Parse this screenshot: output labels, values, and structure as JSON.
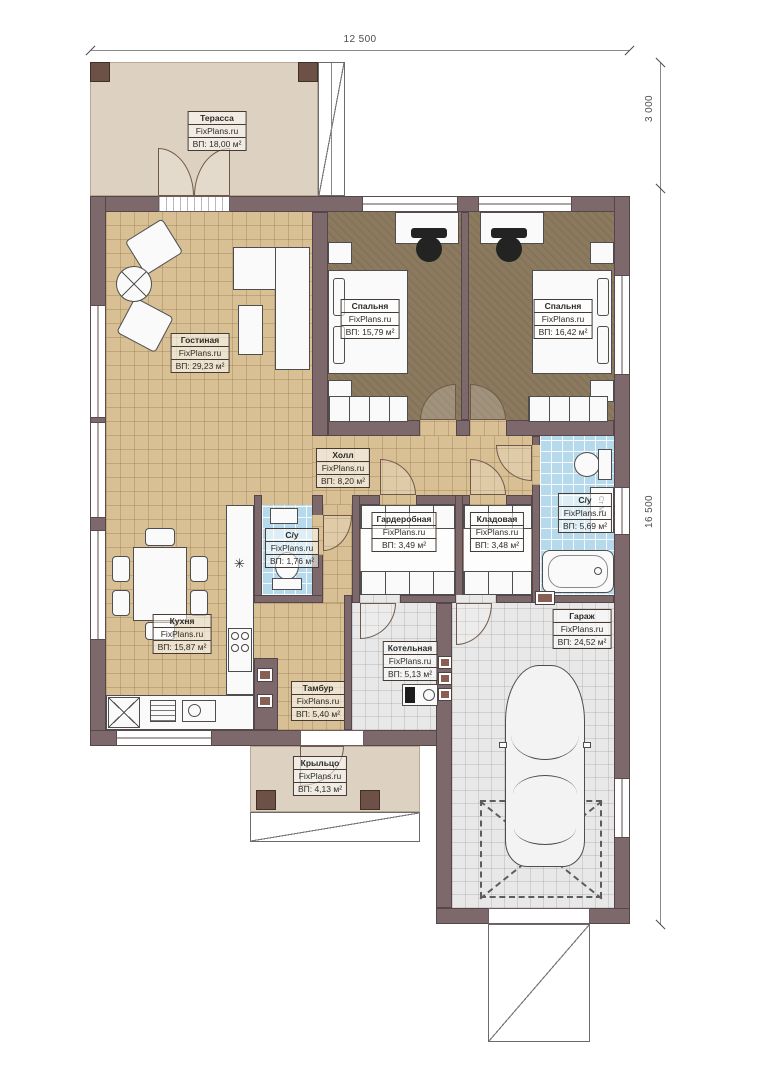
{
  "brand": "FixPlans.ru",
  "dimensions": {
    "width_top": "12 500",
    "terrace_depth": "3 000",
    "height_right": "16 500"
  },
  "rooms": [
    {
      "id": "terrace",
      "name": "Терасса",
      "area": "ВП: 18,00 м²"
    },
    {
      "id": "living",
      "name": "Гостиная",
      "area": "ВП: 29,23 м²"
    },
    {
      "id": "bedroom_left",
      "name": "Спальня",
      "area": "ВП: 15,79 м²"
    },
    {
      "id": "bedroom_right",
      "name": "Спальня",
      "area": "ВП: 16,42 м²"
    },
    {
      "id": "hall",
      "name": "Холл",
      "area": "ВП: 8,20 м²"
    },
    {
      "id": "wardrobe",
      "name": "Гардеробная",
      "area": "ВП: 3,49 м²"
    },
    {
      "id": "storage",
      "name": "Кладовая",
      "area": "ВП: 3,48 м²"
    },
    {
      "id": "bathroom",
      "name": "С/у",
      "area": "ВП: 5,69 м²"
    },
    {
      "id": "wc",
      "name": "С/у",
      "area": "ВП: 1,76 м²"
    },
    {
      "id": "kitchen",
      "name": "Кухня",
      "area": "ВП: 15,87 м²"
    },
    {
      "id": "vestibule",
      "name": "Тамбур",
      "area": "ВП: 5,40 м²"
    },
    {
      "id": "boiler",
      "name": "Котельная",
      "area": "ВП: 5,13 м²"
    },
    {
      "id": "garage",
      "name": "Гараж",
      "area": "ВП: 24,52 м²"
    },
    {
      "id": "porch",
      "name": "Крыльцо",
      "area": "ВП: 4,13 м²"
    }
  ],
  "fixtures": {
    "washer_label": "Ст М",
    "kitchen_symbol": "✳"
  },
  "colors": {
    "wall": "#7d696b",
    "floor_wood": "#d8c094",
    "floor_bedroom": "#8c7a5f",
    "floor_bath": "#b7d9ec",
    "floor_garage": "#e8e8e8",
    "floor_terrace": "#ddd2c1"
  }
}
